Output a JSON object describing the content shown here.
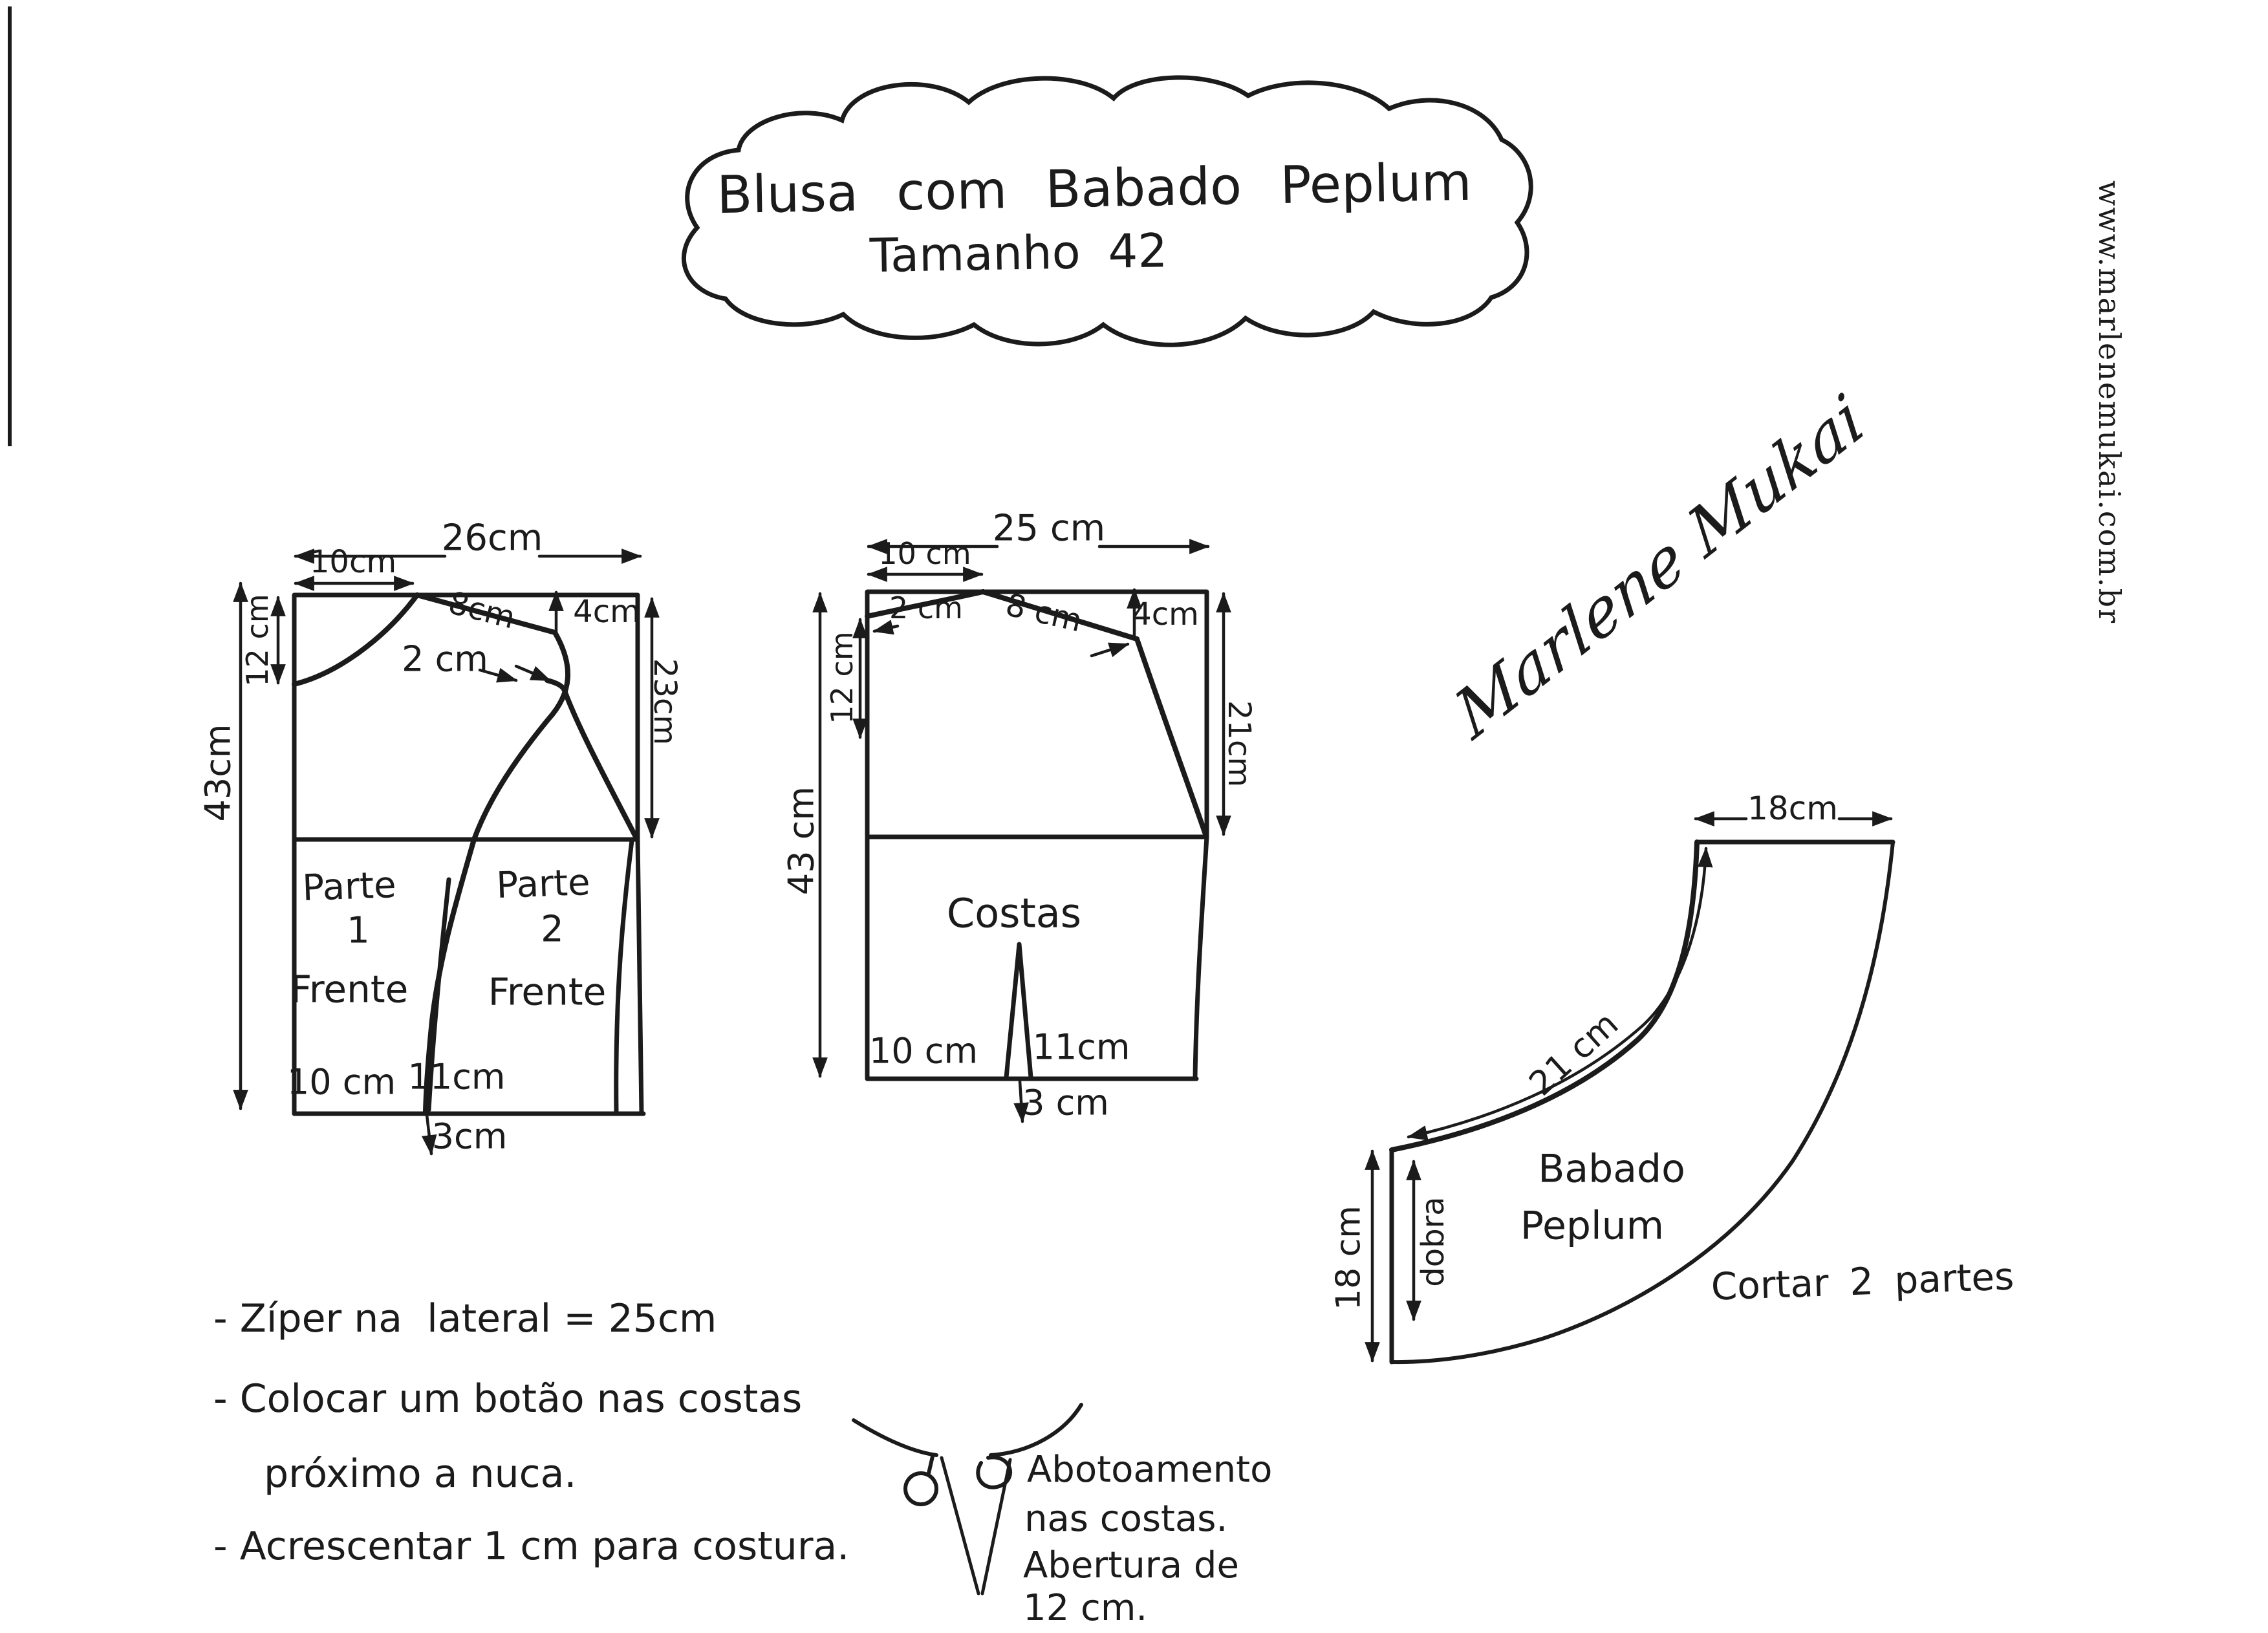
{
  "title": {
    "line1": "Blusa com Babado Peplum",
    "line2": "Tamanho 42"
  },
  "watermark": "www.marlenemukai.com.br",
  "signature": "Marlene Mukai",
  "front": {
    "width": "26cm",
    "neck_width": "10cm",
    "neck_depth": "12 cm",
    "shoulder": "8cm",
    "shoulder_drop": "4cm",
    "armhole_depth": "23cm",
    "length": "43cm",
    "overlap": "2 cm",
    "part1_title": "Parte",
    "part1_number": "1",
    "part1_name": "Frente",
    "part2_title": "Parte",
    "part2_number": "2",
    "part2_name": "Frente",
    "hem_left": "10 cm",
    "hem_right": "11cm",
    "hem_flare": "3cm"
  },
  "back": {
    "width": "25 cm",
    "neck_width": "10 cm",
    "neck_depth": "2 cm",
    "shoulder": "8 cm",
    "shoulder_drop": "4cm",
    "side_depth": "12 cm",
    "armhole_depth": "21cm",
    "length": "43 cm",
    "name": "Costas",
    "hem_left": "10 cm",
    "hem_right": "11cm",
    "hem_flare": "3 cm"
  },
  "peplum": {
    "top_width": "18cm",
    "waist_curve": "21 cm",
    "fold_label": "dobra",
    "side_depth": "18 cm",
    "name_line1": "Babado",
    "name_line2": "Peplum",
    "cut_note": "Cortar 2 partes"
  },
  "notes": {
    "line1": "- Zíper na  lateral = 25cm",
    "line2": "- Colocar um botão nas costas",
    "line3": "próximo a nuca.",
    "line4": "- Acrescentar 1 cm para costura."
  },
  "button_detail": {
    "line1": "Abotoamento",
    "line2": "nas costas.",
    "line3": "Abertura de",
    "line4": "12 cm."
  }
}
